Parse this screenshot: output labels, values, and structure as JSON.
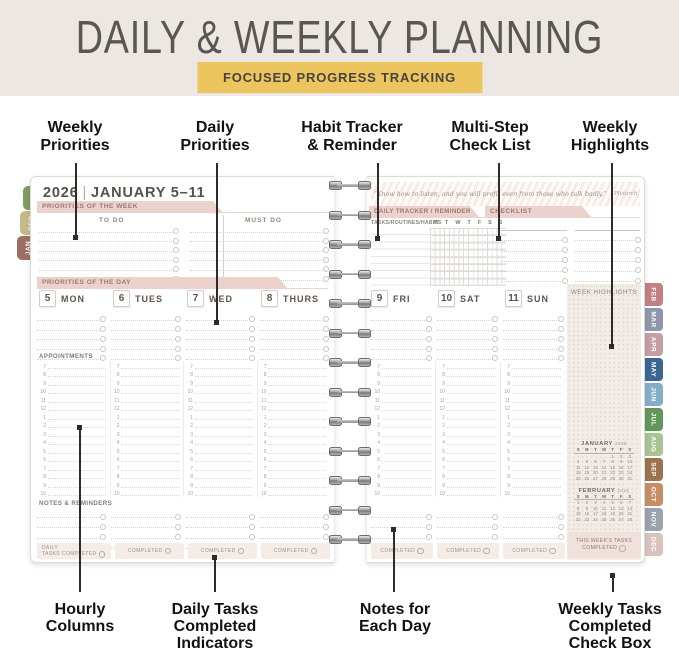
{
  "header": {
    "title": "DAILY & WEEKLY PLANNING",
    "badge": "FOCUSED PROGRESS TRACKING"
  },
  "annotations_top": [
    {
      "lines": [
        "Weekly",
        "Priorities"
      ]
    },
    {
      "lines": [
        "Daily",
        "Priorities"
      ]
    },
    {
      "lines": [
        "Habit Tracker",
        "& Reminder"
      ]
    },
    {
      "lines": [
        "Multi-Step",
        "Check List"
      ]
    },
    {
      "lines": [
        "Weekly",
        "Highlights"
      ]
    }
  ],
  "annotations_bottom": [
    {
      "lines": [
        "Hourly",
        "Columns"
      ]
    },
    {
      "lines": [
        "Daily Tasks",
        "Completed",
        "Indicators"
      ]
    },
    {
      "lines": [
        "Notes for",
        "Each Day"
      ]
    },
    {
      "lines": [
        "Weekly Tasks",
        "Completed",
        "Check Box"
      ]
    }
  ],
  "planner": {
    "left_page": {
      "year": "2026",
      "divider": "|",
      "week_range": "JANUARY 5–11",
      "priorities_week_label": "PRIORITIES OF THE WEEK",
      "todo_label": "TO DO",
      "must_do_label": "MUST DO",
      "priorities_day_label": "PRIORITIES OF THE DAY",
      "appointments_label": "APPOINTMENTS",
      "notes_label": "NOTES & REMINDERS",
      "days": [
        {
          "num": "5",
          "name": "MON"
        },
        {
          "num": "6",
          "name": "TUES"
        },
        {
          "num": "7",
          "name": "WED"
        },
        {
          "num": "8",
          "name": "THURS"
        }
      ],
      "daily_completed_first": [
        "DAILY",
        "TASKS COMPLETED"
      ],
      "completed_label": "COMPLETED"
    },
    "right_page": {
      "quote": "“Know how to listen, and you will profit even from those who talk badly.”",
      "quote_author": "– Plutarch",
      "tracker_label": "DAILY TRACKER / REMINDER",
      "tracker_sub_label": "TASKS/ROUTINES/HABITS",
      "tracker_day_letters": [
        "M",
        "T",
        "W",
        "T",
        "F",
        "S",
        "S"
      ],
      "checklist_label": "CHECKLIST",
      "days": [
        {
          "num": "9",
          "name": "FRI"
        },
        {
          "num": "10",
          "name": "SAT"
        },
        {
          "num": "11",
          "name": "SUN"
        }
      ],
      "week_highlights_label": "WEEK HIGHLIGHTS",
      "completed_label": "COMPLETED",
      "weekly_box_lines": [
        "THIS WEEK'S TASKS",
        "COMPLETED"
      ],
      "calendars": [
        {
          "title": "JANUARY",
          "year": "2026",
          "day_header": [
            "S",
            "M",
            "T",
            "W",
            "T",
            "F",
            "S"
          ],
          "weeks": [
            [
              "",
              "",
              "",
              "",
              "1",
              "2",
              "3"
            ],
            [
              "4",
              "5",
              "6",
              "7",
              "8",
              "9",
              "10"
            ],
            [
              "11",
              "12",
              "13",
              "14",
              "15",
              "16",
              "17"
            ],
            [
              "18",
              "19",
              "20",
              "21",
              "22",
              "23",
              "24"
            ],
            [
              "25",
              "26",
              "27",
              "28",
              "29",
              "30",
              "31"
            ]
          ]
        },
        {
          "title": "FEBRUARY",
          "year": "2026",
          "day_header": [
            "S",
            "M",
            "T",
            "W",
            "T",
            "F",
            "S"
          ],
          "weeks": [
            [
              "1",
              "2",
              "3",
              "4",
              "5",
              "6",
              "7"
            ],
            [
              "8",
              "9",
              "10",
              "11",
              "12",
              "13",
              "14"
            ],
            [
              "15",
              "16",
              "17",
              "18",
              "19",
              "20",
              "21"
            ],
            [
              "22",
              "23",
              "24",
              "25",
              "26",
              "27",
              "28"
            ]
          ]
        }
      ]
    },
    "hour_labels": [
      "7",
      "8",
      "9",
      "10",
      "11",
      "12",
      "1",
      "2",
      "3",
      "4",
      "5",
      "6",
      "7",
      "8",
      "9",
      "10"
    ],
    "left_tabs": [
      {
        "label": "NOV",
        "color": "#7E9C5F"
      },
      {
        "label": "DEC",
        "color": "#C6BA8B"
      },
      {
        "label": "JAN",
        "color": "#9D6F62"
      }
    ],
    "right_tabs": [
      {
        "label": "FEB",
        "color": "#C08084"
      },
      {
        "label": "MAR",
        "color": "#8F96AB"
      },
      {
        "label": "APR",
        "color": "#C79EA6"
      },
      {
        "label": "MAY",
        "color": "#3A6690"
      },
      {
        "label": "JUN",
        "color": "#85AECB"
      },
      {
        "label": "JUL",
        "color": "#61975B"
      },
      {
        "label": "AUG",
        "color": "#A9C493"
      },
      {
        "label": "SEP",
        "color": "#9B7351"
      },
      {
        "label": "OCT",
        "color": "#C68E64"
      },
      {
        "label": "NOV",
        "color": "#9BA3AE"
      },
      {
        "label": "DEC",
        "color": "#D8C3BD"
      }
    ]
  },
  "colors": {
    "band": "#EDE7E3",
    "badge": "#ECC55F",
    "tab_pink": "#EBD2CC"
  }
}
